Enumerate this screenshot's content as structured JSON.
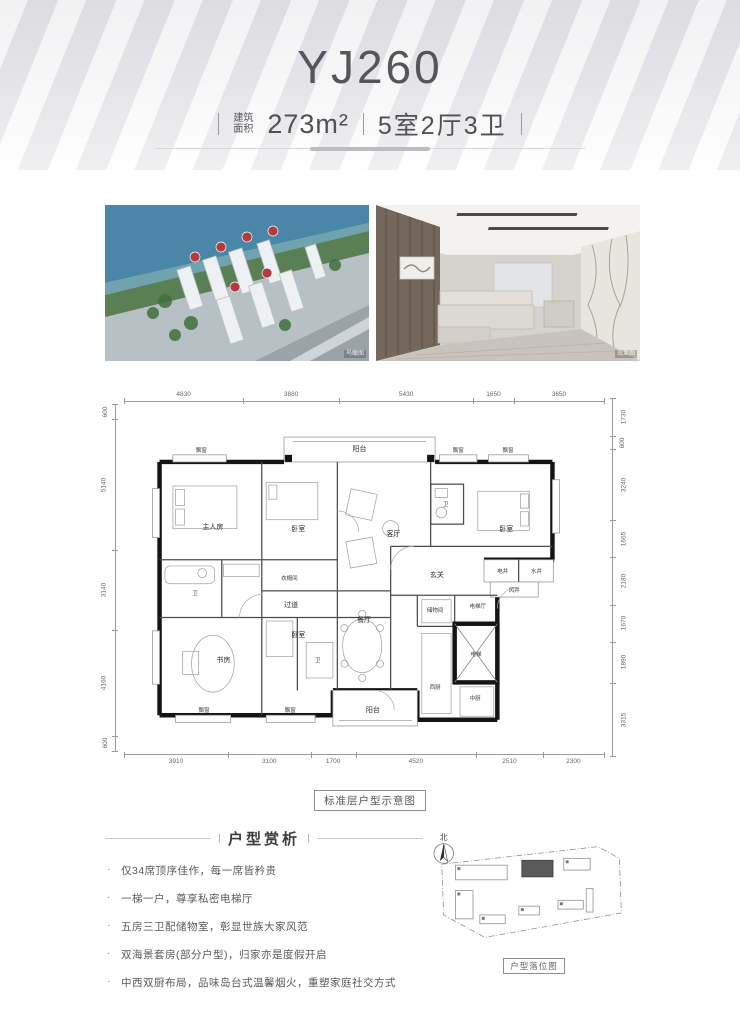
{
  "header": {
    "title": "YJ260",
    "area_label_line1": "建筑",
    "area_label_line2": "面积",
    "area_value": "273m²",
    "layout": "5室2厅3卫"
  },
  "photos": {
    "aerial_watermark": "鸟瞰图",
    "interior_watermark": "效果图"
  },
  "floor_plan": {
    "caption": "标准层户型示意图",
    "dims_top": [
      4830,
      3880,
      5430,
      1650,
      3650
    ],
    "dims_bottom": [
      3910,
      3100,
      1700,
      4520,
      2510,
      2300
    ],
    "dims_left": [
      600,
      5140,
      3140,
      4160,
      600
    ],
    "dims_right": [
      1730,
      600,
      3240,
      1665,
      2180,
      1670,
      1890,
      3315
    ],
    "rooms": [
      {
        "label": "飘窗",
        "x": 87,
        "y": 52,
        "small": true
      },
      {
        "label": "阳台",
        "x": 265,
        "y": 51
      },
      {
        "label": "飘窗",
        "x": 376,
        "y": 52,
        "small": true
      },
      {
        "label": "飘窗",
        "x": 432,
        "y": 52,
        "small": true
      },
      {
        "label": "主人房",
        "x": 100,
        "y": 138
      },
      {
        "label": "卧室",
        "x": 196,
        "y": 140
      },
      {
        "label": "卫",
        "x": 362,
        "y": 112,
        "small": true
      },
      {
        "label": "卧室",
        "x": 430,
        "y": 140
      },
      {
        "label": "衣帽间",
        "x": 186,
        "y": 196,
        "small": true
      },
      {
        "label": "卫",
        "x": 80,
        "y": 212,
        "small": true
      },
      {
        "label": "过道",
        "x": 188,
        "y": 226
      },
      {
        "label": "客厅",
        "x": 303,
        "y": 146
      },
      {
        "label": "玄关",
        "x": 352,
        "y": 192
      },
      {
        "label": "电井",
        "x": 426,
        "y": 188,
        "small": true
      },
      {
        "label": "水井",
        "x": 464,
        "y": 188,
        "small": true
      },
      {
        "label": "风井",
        "x": 439,
        "y": 209,
        "small": true
      },
      {
        "label": "书房",
        "x": 112,
        "y": 288
      },
      {
        "label": "卧室",
        "x": 196,
        "y": 260
      },
      {
        "label": "卫",
        "x": 218,
        "y": 288,
        "small": true
      },
      {
        "label": "餐厅",
        "x": 270,
        "y": 243
      },
      {
        "label": "储物间",
        "x": 350,
        "y": 231,
        "small": true
      },
      {
        "label": "电梯厅",
        "x": 398,
        "y": 227,
        "small": true
      },
      {
        "label": "电梯",
        "x": 396,
        "y": 281,
        "small": true
      },
      {
        "label": "西厨",
        "x": 350,
        "y": 318,
        "small": true
      },
      {
        "label": "中厨",
        "x": 395,
        "y": 330,
        "small": true
      },
      {
        "label": "飘窗",
        "x": 90,
        "y": 344,
        "small": true
      },
      {
        "label": "飘窗",
        "x": 187,
        "y": 344,
        "small": true
      },
      {
        "label": "阳台",
        "x": 280,
        "y": 344
      }
    ]
  },
  "analysis": {
    "title": "户型赏析",
    "bullets": [
      "仅34席顶序佳作，每一席皆矜贵",
      "一梯一户，尊享私密电梯厅",
      "五房三卫配储物室，彰显世族大家风范",
      "双海景套房(部分户型)，归家亦是度假开启",
      "中西双厨布局，品味岛台式温馨烟火，重塑家庭社交方式"
    ]
  },
  "site_plan": {
    "north_label": "北",
    "caption": "户型落位图"
  }
}
